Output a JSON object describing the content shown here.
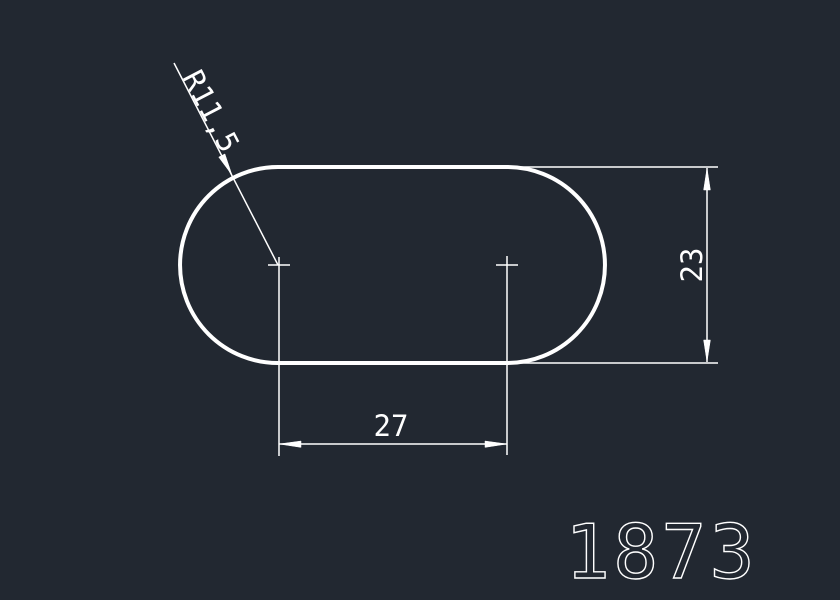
{
  "drawing": {
    "part_number": "1873",
    "dimensions": {
      "radius": "R11,5",
      "height": "23",
      "width": "27"
    },
    "colors": {
      "background": "#222831",
      "line": "#ffffff"
    }
  }
}
